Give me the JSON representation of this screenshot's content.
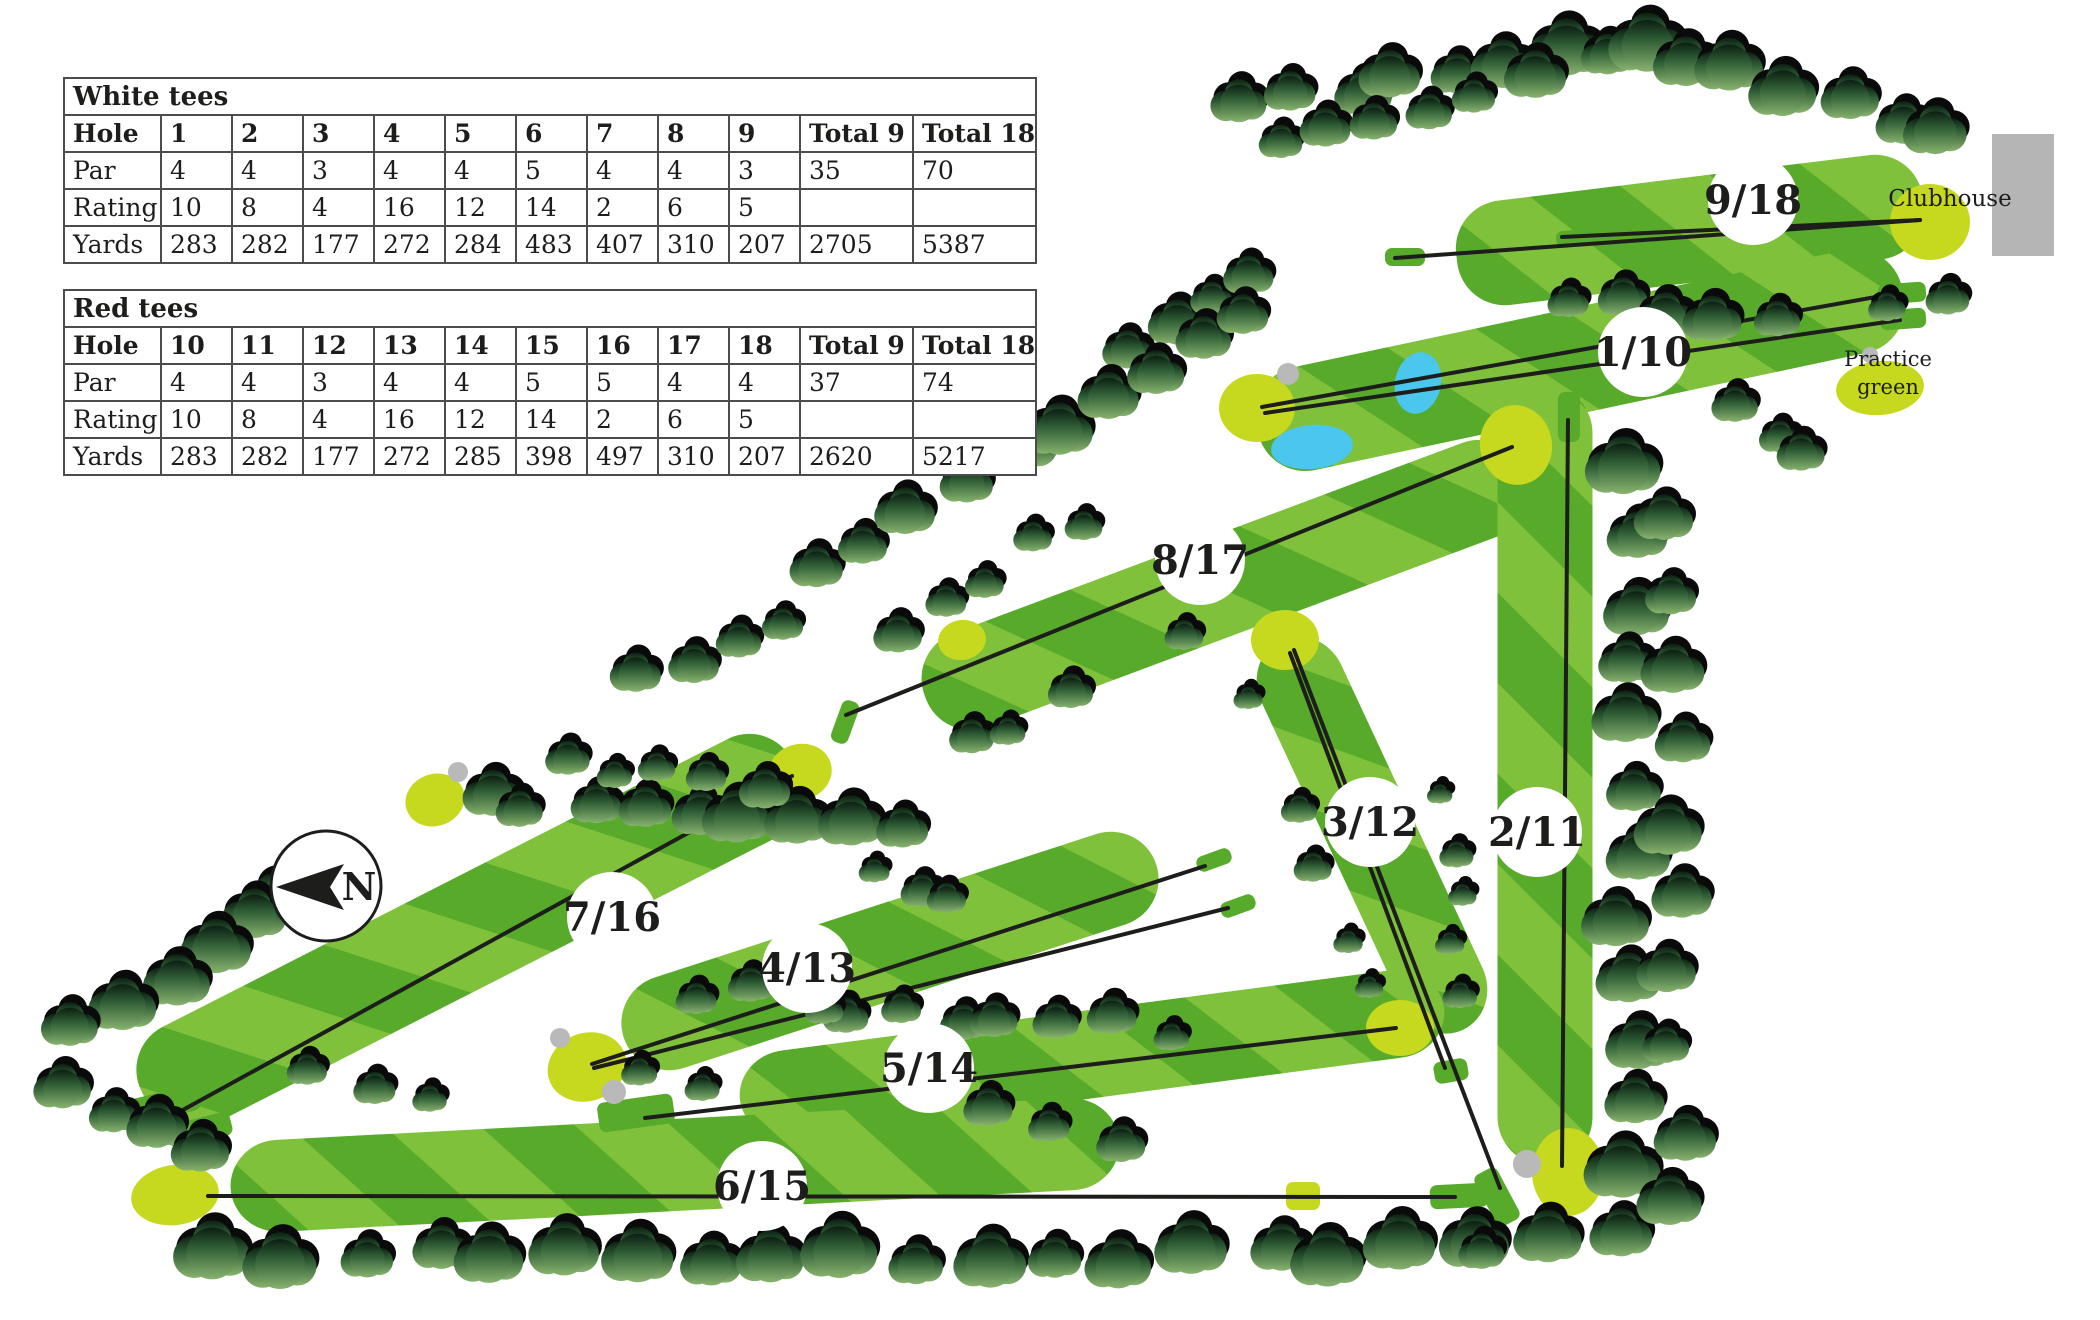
{
  "tables": {
    "white": {
      "title": "White tees",
      "header": [
        "Hole",
        "1",
        "2",
        "3",
        "4",
        "5",
        "6",
        "7",
        "8",
        "9",
        "Total 9",
        "Total 18"
      ],
      "rows": [
        [
          "Par",
          "4",
          "4",
          "3",
          "4",
          "4",
          "5",
          "4",
          "4",
          "3",
          "35",
          "70"
        ],
        [
          "Rating",
          "10",
          "8",
          "4",
          "16",
          "12",
          "14",
          "2",
          "6",
          "5",
          "",
          ""
        ],
        [
          "Yards",
          "283",
          "282",
          "177",
          "272",
          "284",
          "483",
          "407",
          "310",
          "207",
          "2705",
          "5387"
        ]
      ]
    },
    "red": {
      "title": "Red tees",
      "header": [
        "Hole",
        "10",
        "11",
        "12",
        "13",
        "14",
        "15",
        "16",
        "17",
        "18",
        "Total 9",
        "Total 18"
      ],
      "rows": [
        [
          "Par",
          "4",
          "4",
          "3",
          "4",
          "4",
          "5",
          "5",
          "4",
          "4",
          "37",
          "74"
        ],
        [
          "Rating",
          "10",
          "8",
          "4",
          "16",
          "12",
          "14",
          "2",
          "6",
          "5",
          "",
          ""
        ],
        [
          "Yards",
          "283",
          "282",
          "177",
          "272",
          "285",
          "398",
          "497",
          "310",
          "207",
          "2620",
          "5217"
        ]
      ]
    }
  },
  "compass": {
    "label": "N"
  },
  "map": {
    "labels": {
      "clubhouse": {
        "text": "Clubhouse",
        "x": 1950,
        "y": 206
      },
      "practice_green_line1": {
        "text": "Practice",
        "x": 1888,
        "y": 366
      },
      "practice_green_line2": {
        "text": "green",
        "x": 1888,
        "y": 394
      }
    },
    "hole_markers": [
      {
        "label": "1/10",
        "x": 1643,
        "y": 352
      },
      {
        "label": "2/11",
        "x": 1537,
        "y": 832
      },
      {
        "label": "3/12",
        "x": 1370,
        "y": 822
      },
      {
        "label": "4/13",
        "x": 807,
        "y": 968
      },
      {
        "label": "5/14",
        "x": 929,
        "y": 1068
      },
      {
        "label": "6/15",
        "x": 762,
        "y": 1186
      },
      {
        "label": "7/16",
        "x": 612,
        "y": 917
      },
      {
        "label": "8/17",
        "x": 1200,
        "y": 560
      },
      {
        "label": "9/18",
        "x": 1753,
        "y": 200
      }
    ]
  },
  "colors": {
    "fairway_dark": "#58aa2b",
    "fairway_light": "#80c13c",
    "green": "#c6d91e",
    "water": "#4bc7ee",
    "bunker": "#b9b9b9",
    "building": "#b5b5b5",
    "tree_dark": "#0b1f12",
    "tree_mid": "#2f5d35",
    "tree_light": "#88b36f",
    "line": "#1d1d1b"
  }
}
